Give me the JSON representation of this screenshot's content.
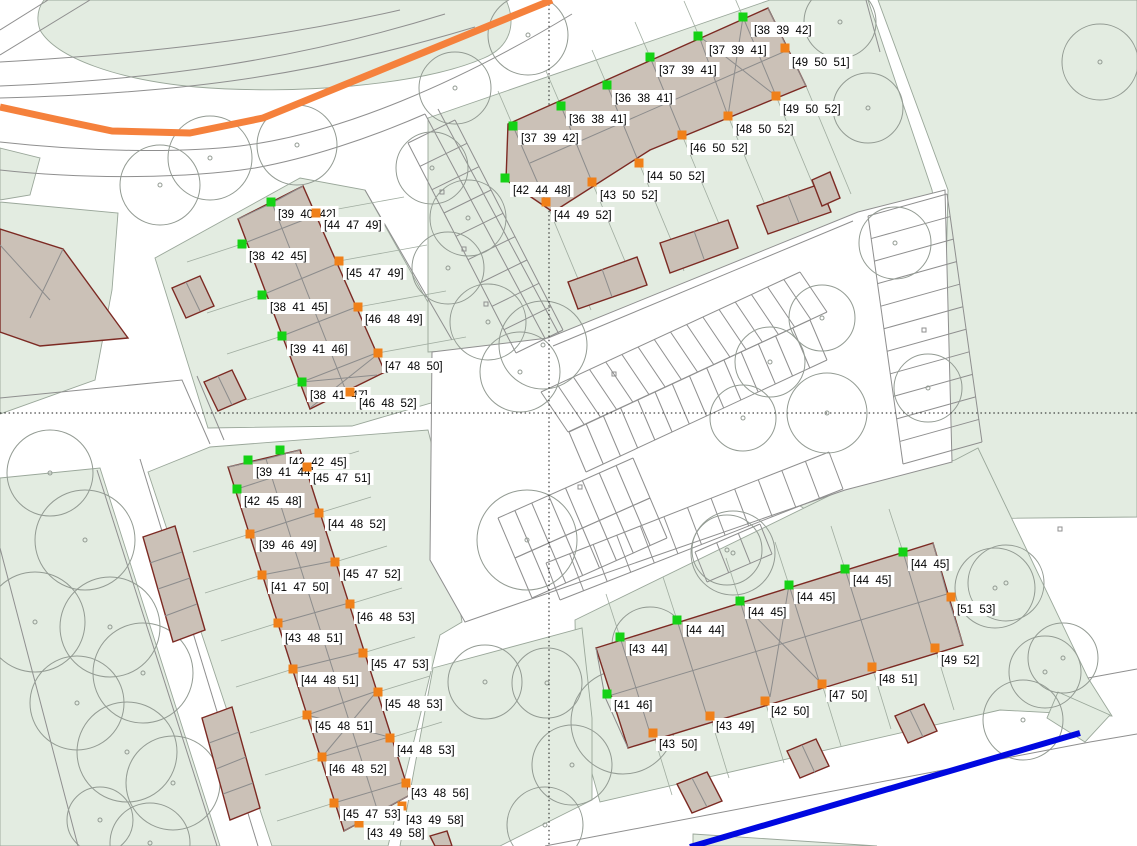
{
  "scene": {
    "width": 1137,
    "height": 846
  },
  "colors": {
    "green_marker": "#15d215",
    "orange_marker": "#f08019",
    "parcel_green": "#e3ece1",
    "building_fill": "#cbc1b7",
    "building_outline": "#7c2a23",
    "route_orange": "#f5813c",
    "route_blue": "#0008e0",
    "label_bg": "#ffffff",
    "label_text": "#000000"
  },
  "buildings": [
    {
      "name": "north-terrace",
      "markers": [
        {
          "x": 743,
          "y": 17,
          "c": "green",
          "t": "[38  39  42]",
          "lx": 751,
          "ly": 22
        },
        {
          "x": 698,
          "y": 36,
          "c": "green",
          "t": "[37  39  41]",
          "lx": 706,
          "ly": 42
        },
        {
          "x": 650,
          "y": 57,
          "c": "green",
          "t": "[37  39  41]",
          "lx": 656,
          "ly": 62
        },
        {
          "x": 607,
          "y": 85,
          "c": "green",
          "t": "[36  38  41]",
          "lx": 612,
          "ly": 90
        },
        {
          "x": 561,
          "y": 106,
          "c": "green",
          "t": "[36  38  41]",
          "lx": 566,
          "ly": 111
        },
        {
          "x": 513,
          "y": 126,
          "c": "green",
          "t": "[37  39  42]",
          "lx": 518,
          "ly": 130
        },
        {
          "x": 505,
          "y": 178,
          "c": "green",
          "t": "[42  44  48]",
          "lx": 510,
          "ly": 182
        },
        {
          "x": 785,
          "y": 48,
          "c": "orange",
          "t": "[49  50  51]",
          "lx": 789,
          "ly": 54
        },
        {
          "x": 776,
          "y": 96,
          "c": "orange",
          "t": "[49  50  52]",
          "lx": 780,
          "ly": 101
        },
        {
          "x": 728,
          "y": 116,
          "c": "orange",
          "t": "[48  50  52]",
          "lx": 733,
          "ly": 121
        },
        {
          "x": 682,
          "y": 135,
          "c": "orange",
          "t": "[46  50  52]",
          "lx": 687,
          "ly": 140
        },
        {
          "x": 639,
          "y": 163,
          "c": "orange",
          "t": "[44  50  52]",
          "lx": 644,
          "ly": 168
        },
        {
          "x": 592,
          "y": 182,
          "c": "orange",
          "t": "[43  50  52]",
          "lx": 597,
          "ly": 187
        },
        {
          "x": 546,
          "y": 202,
          "c": "orange",
          "t": "[44  49  52]",
          "lx": 551,
          "ly": 207
        }
      ]
    },
    {
      "name": "west-terrace",
      "markers": [
        {
          "x": 271,
          "y": 202,
          "c": "green",
          "t": "[39  40  42]",
          "lx": 275,
          "ly": 206
        },
        {
          "x": 242,
          "y": 244,
          "c": "green",
          "t": "[38  42  45]",
          "lx": 246,
          "ly": 248
        },
        {
          "x": 262,
          "y": 295,
          "c": "green",
          "t": "[38  41  45]",
          "lx": 267,
          "ly": 299
        },
        {
          "x": 282,
          "y": 336,
          "c": "green",
          "t": "[39  41  46]",
          "lx": 287,
          "ly": 341
        },
        {
          "x": 302,
          "y": 382,
          "c": "green",
          "t": "[38  41  47]",
          "lx": 307,
          "ly": 387
        },
        {
          "x": 316,
          "y": 213,
          "c": "orange",
          "t": "[44  47  49]",
          "lx": 321,
          "ly": 217
        },
        {
          "x": 339,
          "y": 261,
          "c": "orange",
          "t": "[45  47  49]",
          "lx": 343,
          "ly": 265
        },
        {
          "x": 358,
          "y": 307,
          "c": "orange",
          "t": "[46  48  49]",
          "lx": 362,
          "ly": 311
        },
        {
          "x": 378,
          "y": 353,
          "c": "orange",
          "t": "[47  48  50]",
          "lx": 382,
          "ly": 358
        },
        {
          "x": 350,
          "y": 392,
          "c": "orange",
          "t": "[46  48  52]",
          "lx": 356,
          "ly": 395
        }
      ]
    },
    {
      "name": "southwest-terrace",
      "markers": [
        {
          "x": 280,
          "y": 450,
          "c": "green",
          "t": "[42  42  45]",
          "lx": 286,
          "ly": 454
        },
        {
          "x": 248,
          "y": 460,
          "c": "green",
          "t": "[39  41  44]",
          "lx": 253,
          "ly": 464
        },
        {
          "x": 237,
          "y": 489,
          "c": "green",
          "t": "[42  45  48]",
          "lx": 241,
          "ly": 493
        },
        {
          "x": 307,
          "y": 467,
          "c": "orange",
          "t": "[45  47  51]",
          "lx": 310,
          "ly": 470
        },
        {
          "x": 319,
          "y": 513,
          "c": "orange",
          "t": "[44  48  52]",
          "lx": 325,
          "ly": 516
        },
        {
          "x": 335,
          "y": 562,
          "c": "orange",
          "t": "[45  47  52]",
          "lx": 340,
          "ly": 566
        },
        {
          "x": 350,
          "y": 604,
          "c": "orange",
          "t": "[46  48  53]",
          "lx": 354,
          "ly": 609
        },
        {
          "x": 363,
          "y": 653,
          "c": "orange",
          "t": "[45  47  53]",
          "lx": 368,
          "ly": 656
        },
        {
          "x": 378,
          "y": 692,
          "c": "orange",
          "t": "[45  48  53]",
          "lx": 382,
          "ly": 696
        },
        {
          "x": 390,
          "y": 738,
          "c": "orange",
          "t": "[44  48  53]",
          "lx": 394,
          "ly": 742
        },
        {
          "x": 406,
          "y": 783,
          "c": "orange",
          "t": "[43  48  56]",
          "lx": 408,
          "ly": 785
        },
        {
          "x": 402,
          "y": 806,
          "c": "orange",
          "t": "[43  49  58]",
          "lx": 403,
          "ly": 812
        },
        {
          "x": 359,
          "y": 823,
          "c": "orange",
          "t": "[43  49  58]",
          "lx": 364,
          "ly": 825
        },
        {
          "x": 250,
          "y": 534,
          "c": "orange",
          "t": "[39  46  49]",
          "lx": 256,
          "ly": 537
        },
        {
          "x": 262,
          "y": 575,
          "c": "orange",
          "t": "[41  47  50]",
          "lx": 268,
          "ly": 579
        },
        {
          "x": 278,
          "y": 623,
          "c": "orange",
          "t": "[43  48  51]",
          "lx": 282,
          "ly": 630
        },
        {
          "x": 293,
          "y": 669,
          "c": "orange",
          "t": "[44  48  51]",
          "lx": 298,
          "ly": 672
        },
        {
          "x": 307,
          "y": 715,
          "c": "orange",
          "t": "[45  48  51]",
          "lx": 312,
          "ly": 718
        },
        {
          "x": 322,
          "y": 757,
          "c": "orange",
          "t": "[46  48  52]",
          "lx": 326,
          "ly": 761
        },
        {
          "x": 334,
          "y": 803,
          "c": "orange",
          "t": "[45  47  53]",
          "lx": 340,
          "ly": 806
        }
      ]
    },
    {
      "name": "southeast-terrace",
      "markers": [
        {
          "x": 903,
          "y": 552,
          "c": "green",
          "t": "[44  45]",
          "lx": 908,
          "ly": 556
        },
        {
          "x": 845,
          "y": 569,
          "c": "green",
          "t": "[44  45]",
          "lx": 850,
          "ly": 572
        },
        {
          "x": 789,
          "y": 585,
          "c": "green",
          "t": "[44  45]",
          "lx": 794,
          "ly": 589
        },
        {
          "x": 740,
          "y": 601,
          "c": "green",
          "t": "[44  45]",
          "lx": 745,
          "ly": 604
        },
        {
          "x": 677,
          "y": 620,
          "c": "green",
          "t": "[44  44]",
          "lx": 683,
          "ly": 622
        },
        {
          "x": 620,
          "y": 637,
          "c": "green",
          "t": "[43  44]",
          "lx": 626,
          "ly": 641
        },
        {
          "x": 607,
          "y": 694,
          "c": "green",
          "t": "[41  46]",
          "lx": 611,
          "ly": 697
        },
        {
          "x": 951,
          "y": 597,
          "c": "orange",
          "t": "[51  53]",
          "lx": 954,
          "ly": 601
        },
        {
          "x": 935,
          "y": 648,
          "c": "orange",
          "t": "[49  52]",
          "lx": 938,
          "ly": 652
        },
        {
          "x": 872,
          "y": 667,
          "c": "orange",
          "t": "[48  51]",
          "lx": 876,
          "ly": 671
        },
        {
          "x": 822,
          "y": 684,
          "c": "orange",
          "t": "[47  50]",
          "lx": 826,
          "ly": 687
        },
        {
          "x": 765,
          "y": 701,
          "c": "orange",
          "t": "[42  50]",
          "lx": 768,
          "ly": 703
        },
        {
          "x": 710,
          "y": 716,
          "c": "orange",
          "t": "[43  49]",
          "lx": 713,
          "ly": 718
        },
        {
          "x": 653,
          "y": 733,
          "c": "orange",
          "t": "[43  50]",
          "lx": 656,
          "ly": 736
        }
      ]
    }
  ]
}
